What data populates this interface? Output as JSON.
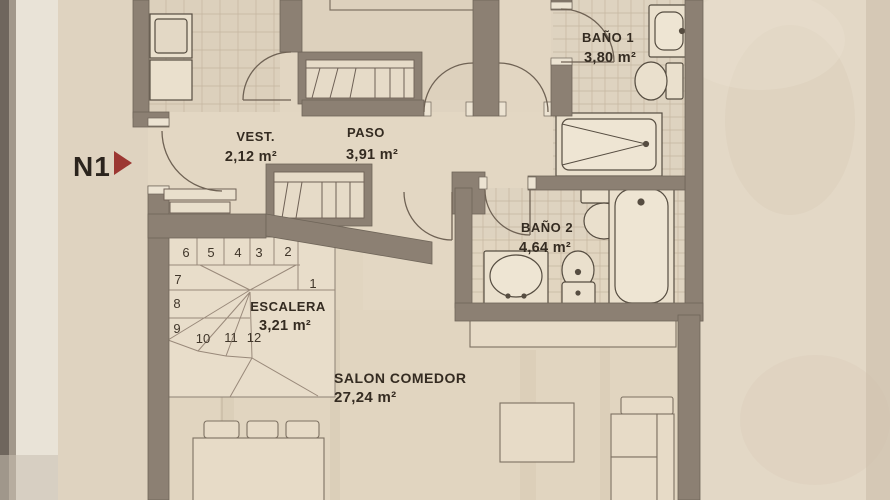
{
  "plan": {
    "marker": {
      "label": "N1"
    },
    "rooms": {
      "vest": {
        "name": "VEST.",
        "area": "2,12 m²"
      },
      "paso": {
        "name": "PASO",
        "area": "3,91 m²"
      },
      "bano1": {
        "name": "BAÑO 1",
        "area": "3,80 m²"
      },
      "bano2": {
        "name": "BAÑO 2",
        "area": "4,64 m²"
      },
      "escalera": {
        "name": "ESCALERA",
        "area": "3,21 m²"
      },
      "salon": {
        "name": "SALON COMEDOR",
        "area": "27,24 m²"
      }
    },
    "stairs": {
      "steps": [
        "1",
        "2",
        "3",
        "4",
        "5",
        "6",
        "7",
        "8",
        "9",
        "10",
        "11",
        "12"
      ]
    },
    "colors": {
      "wall": "#8c8073",
      "floor": "#e3d7c3",
      "tile_line": "#c2b29c",
      "accent_red": "#9c3732",
      "text": "#342b21"
    }
  }
}
